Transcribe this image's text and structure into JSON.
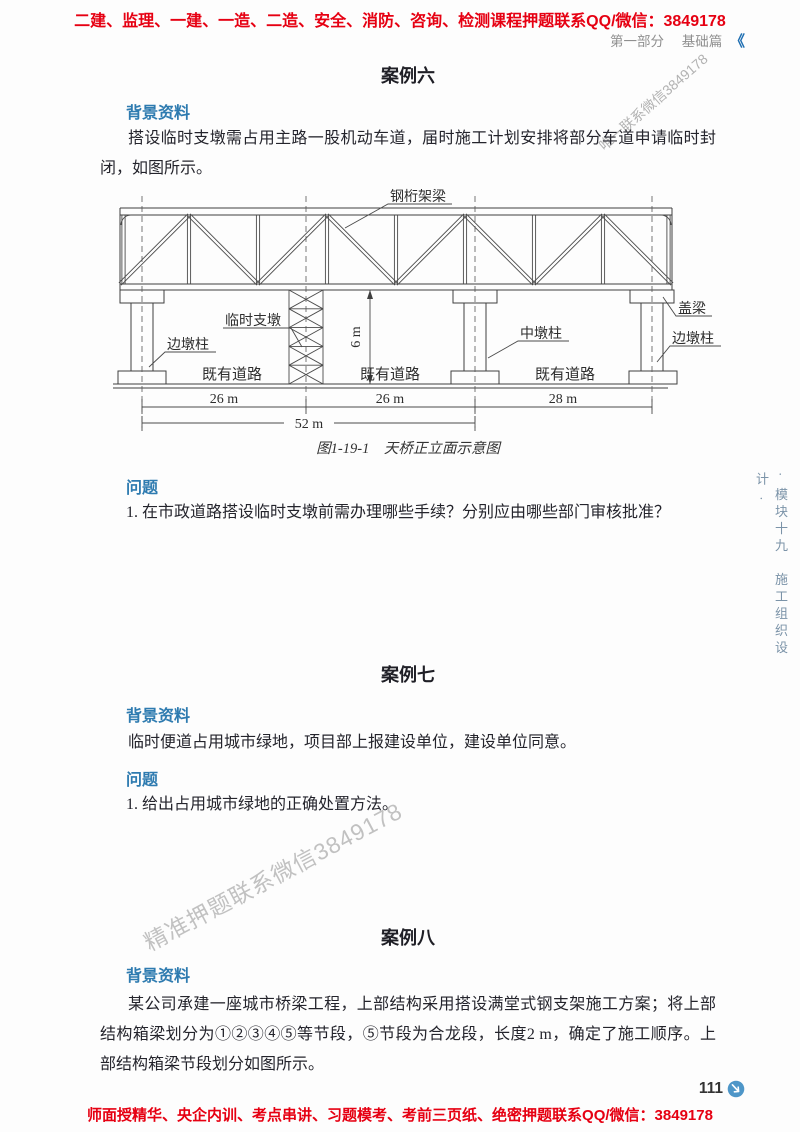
{
  "banners": {
    "top": "二建、监理、一建、一造、二造、安全、消防、咨询、检测课程押题联系QQ/微信：3849178",
    "bottom": "师面授精华、央企内训、考点串讲、习题模考、考前三页纸、绝密押题联系QQ/微信：3849178"
  },
  "header": {
    "part": "第一部分",
    "section": "基础篇",
    "mark": "《"
  },
  "watermarks": {
    "top": "唯一联系微信3849178",
    "middle": "精准押题联系微信3849178"
  },
  "sidebar": {
    "vertical_text": "· 模块十九　施工组织设计 ·"
  },
  "cases": [
    {
      "title": "案例六",
      "background_label": "背景资料",
      "background": "搭设临时支墩需占用主路一股机动车道，届时施工计划安排将部分车道申请临时封闭，如图所示。",
      "question_label": "问题",
      "question": "1. 在市政道路搭设临时支墩前需办理哪些手续？分别应由哪些部门审核批准？"
    },
    {
      "title": "案例七",
      "background_label": "背景资料",
      "background": "临时便道占用城市绿地，项目部上报建设单位，建设单位同意。",
      "question_label": "问题",
      "question": "1. 给出占用城市绿地的正确处置方法。"
    },
    {
      "title": "案例八",
      "background_label": "背景资料",
      "background": "某公司承建一座城市桥梁工程，上部结构采用搭设满堂式钢支架施工方案；将上部结构箱梁划分为①②③④⑤等节段，⑤节段为合龙段，长度2 m，确定了施工顺序。上部结构箱梁节段划分如图所示。"
    }
  ],
  "figure": {
    "caption": "图1-19-1　天桥正立面示意图",
    "labels": {
      "girder": "钢桁架梁",
      "temp_support": "临时支墩",
      "side_pier_left": "边墩柱",
      "mid_pier": "中墩柱",
      "cap_beam": "盖梁",
      "side_pier_right": "边墩柱",
      "road_1": "既有道路",
      "road_2": "既有道路",
      "road_3": "既有道路"
    },
    "dimensions": {
      "height": "6 m",
      "span_1": "26 m",
      "span_2": "26 m",
      "span_3": "28 m",
      "total": "52 m"
    }
  },
  "footer": {
    "page_number": "111"
  },
  "colors": {
    "accent_red": "#e60012",
    "heading_blue": "#2e7bb0",
    "mark_blue": "#1f6fb2",
    "icon_blue": "#4e96c8",
    "sidebar_blue": "#7b93a8"
  }
}
